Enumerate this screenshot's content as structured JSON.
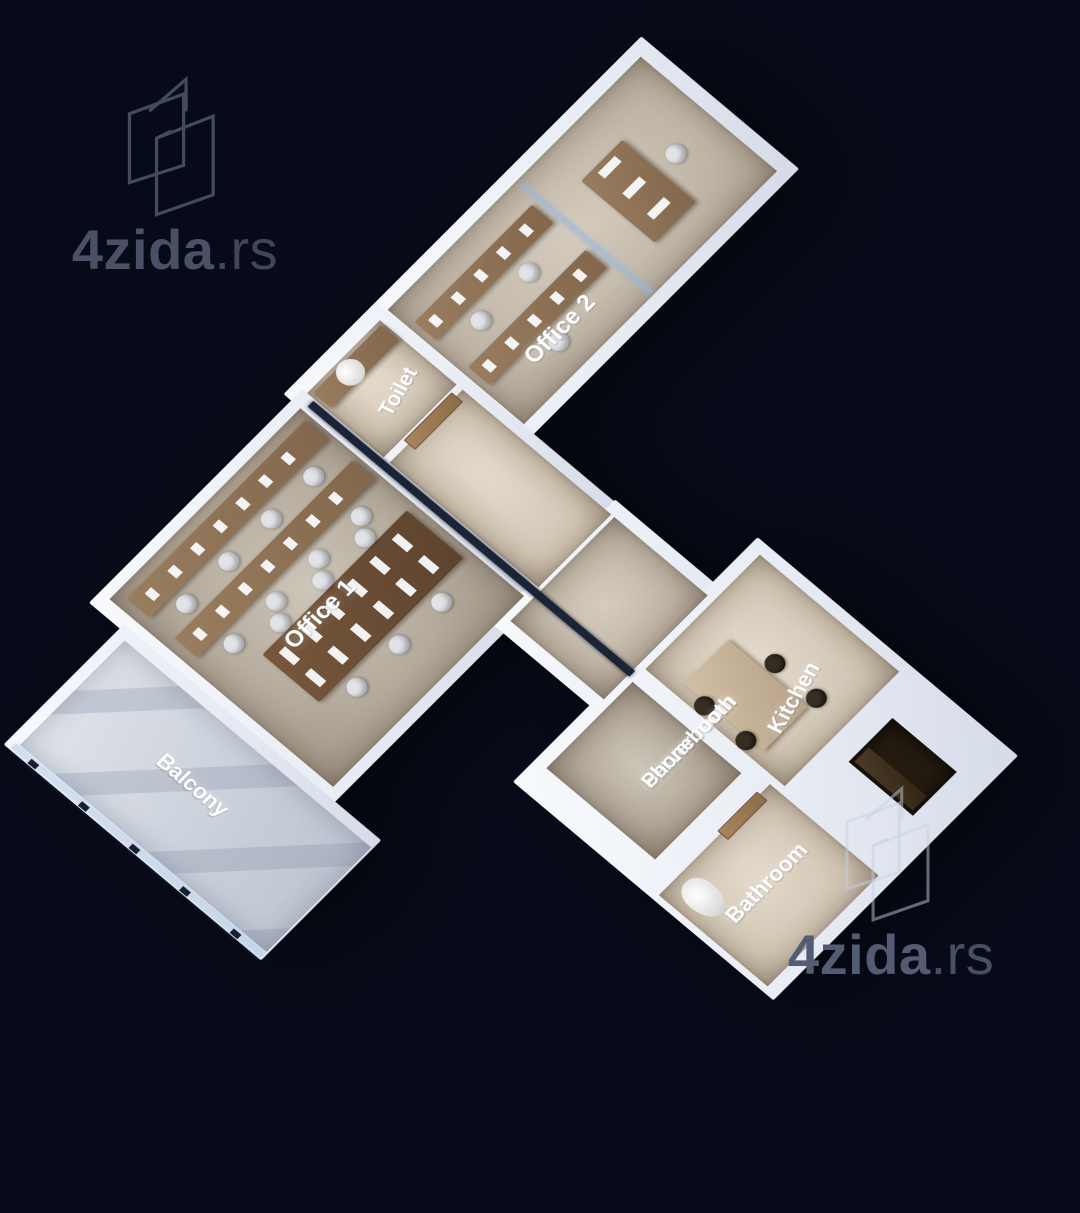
{
  "background": "#070b19",
  "watermark": {
    "brand": "4zida",
    "tld": ".rs"
  },
  "rooms": {
    "office1": {
      "label": "Office 1"
    },
    "office2": {
      "label": "Office 2"
    },
    "toilet": {
      "label": "Toilet"
    },
    "balcony": {
      "label": "Balcony"
    },
    "server_phone": {
      "label_line1": "Server room",
      "label_line2": "Phonebooth"
    },
    "kitchen": {
      "label": "Kitchen"
    },
    "bathroom": {
      "label": "Bathroom"
    }
  },
  "palette": {
    "background": "#070b19",
    "wall": "#e9edf4",
    "floor_warm": "#b3aa9c",
    "floor_light": "#d1c5b4",
    "balcony_floor": "#ccd2dc",
    "desk_wood": "#8c7054",
    "bench_wood": "#6a4f38",
    "door_wood": "#9c7c5a",
    "glass": "#96b6da",
    "label_text": "#ffffff",
    "watermark_text": "#4a5166"
  }
}
